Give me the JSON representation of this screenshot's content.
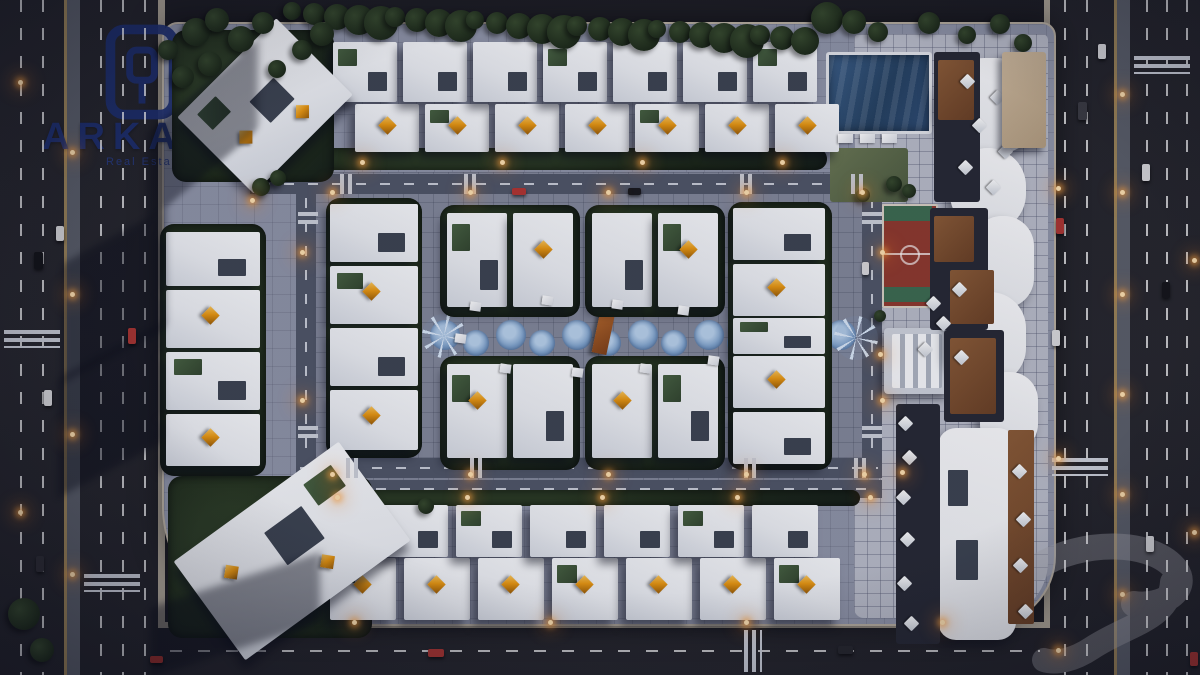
{
  "logo": {
    "name": "ARKAN",
    "tagline": "Real Estate Development",
    "icon": "arkan-monogram-icon"
  },
  "watermark": {
    "icon": "ghost-brand-glyph"
  },
  "scene": {
    "type": "aerial-3d-masterplan-render",
    "time_of_day": "dusk",
    "amenities": [
      "swimming-pool",
      "lawn",
      "sun-loungers",
      "sports-court",
      "pergola",
      "central-water-feature",
      "curved-promenade-canopy",
      "seating-terraces"
    ],
    "colors": {
      "navy": "#1d2f70",
      "accent": "#e8960f",
      "asphalt": "#242429",
      "paving": "#8f94a7",
      "pool": "#2d4b72",
      "court_red": "#8f382c",
      "court_green": "#3c6b4f",
      "hedge": "#1e2a19",
      "canopy": "#f3f4f6",
      "deck": "#7a4c2d",
      "glow": "#ffb054"
    }
  }
}
